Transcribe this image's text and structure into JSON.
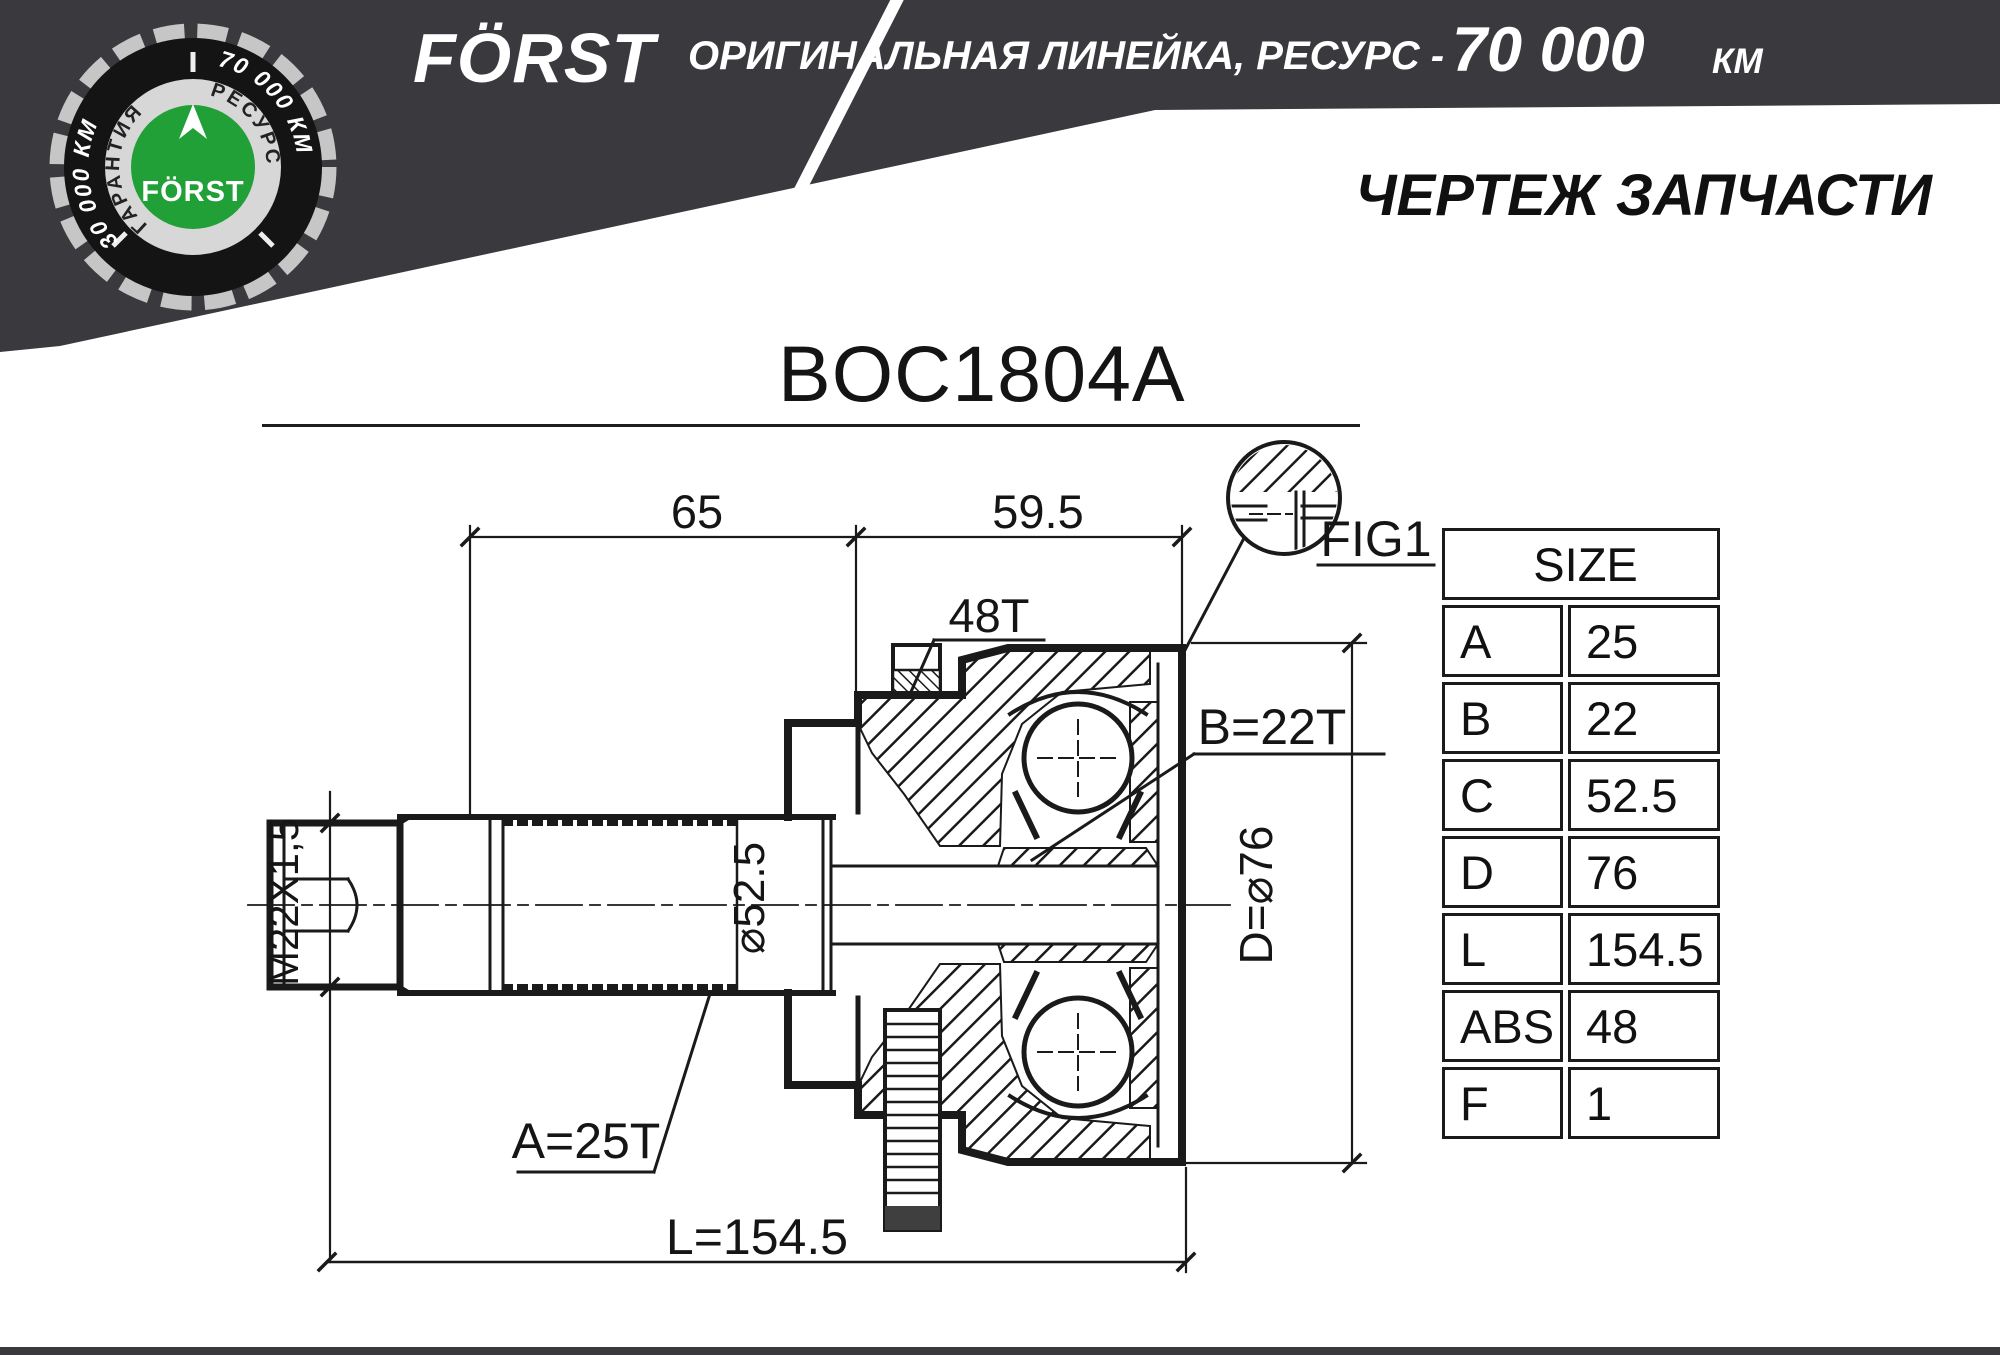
{
  "header": {
    "brand": "FÖRST",
    "tagline": "ОРИГИНАЛЬНАЯ ЛИНЕЙКА, РЕСУРС -",
    "resource_value": "70 000",
    "resource_unit": "КМ",
    "bg_color": "#3a393d"
  },
  "badge": {
    "arc_left": "30 000 КМ",
    "arc_right": "70 000 КМ",
    "ring_left": "ГАРАНТИЯ",
    "ring_right": "РЕСУРС",
    "brand": "FÖRST",
    "green": "#21a038",
    "ring_gray": "#d7d7d7",
    "dark": "#141414"
  },
  "page_title": "ЧЕРТЕЖ ЗАПЧАСТИ",
  "part_number": "BOC1804A",
  "drawing": {
    "line_color": "#1a1a1a",
    "dims": {
      "d65": "65",
      "d595": "59.5",
      "teeth": "48T",
      "fig": "FIG1",
      "spline_b": "B=22T",
      "dia_d": "D=⌀76",
      "dia_c": "⌀52.5",
      "thread": "M22X1,5",
      "spline_a": "A=25T",
      "length": "L=154.5"
    }
  },
  "size_table": {
    "header": "SIZE",
    "rows": [
      {
        "label": "A",
        "value": "25"
      },
      {
        "label": "B",
        "value": "22"
      },
      {
        "label": "C",
        "value": "52.5"
      },
      {
        "label": "D",
        "value": "76"
      },
      {
        "label": "L",
        "value": "154.5"
      },
      {
        "label": "ABS",
        "value": "48"
      },
      {
        "label": "F",
        "value": "1"
      }
    ]
  }
}
